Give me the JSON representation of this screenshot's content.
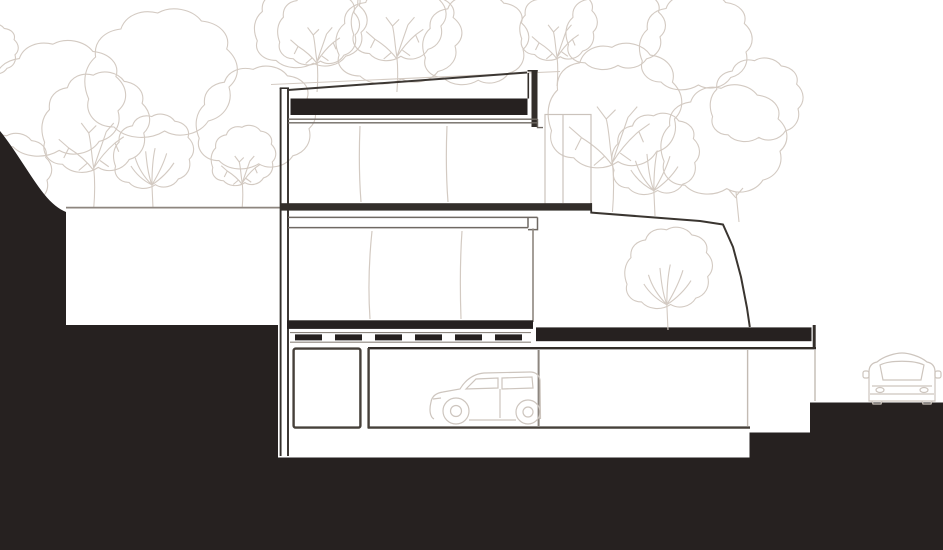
{
  "title": "Hillside house cross-section drawing",
  "colors": {
    "background": "#ffffff",
    "terrain": "#262120",
    "section": "#332e2a",
    "line_medium": "#6f6963",
    "line_light": "#8d867f",
    "room_outline": "#46403a",
    "vegetation": "#d3cac2",
    "vehicle_outline": "#cdc5be",
    "faint_volume": "#cbc3bc"
  },
  "scene": {
    "type": "architectural section through a house built into a slope",
    "site": {
      "left": "hillside cut drawn as solid dark fill stepping down toward the house",
      "right": "ground stepping down in two terraces to street level"
    },
    "building": {
      "levels": [
        {
          "name": "roof",
          "feature": "flat roof with dark gravel band, sloped edge line and parapets"
        },
        {
          "name": "upper-floor",
          "feature": "open glazed floor with faint mullion lines"
        },
        {
          "name": "ground-floor",
          "feature": "glazed floor, slab running out to meet the terrain"
        },
        {
          "name": "basement",
          "rooms": [
            "storage room",
            "garage",
            "carport"
          ]
        }
      ],
      "extras": [
        "deck slats over garage slab",
        "dark terrace roof band with tree planted on it",
        "set-back stair volume drawn faint"
      ]
    },
    "vehicles": [
      {
        "name": "car in garage",
        "view": "side, facing left"
      },
      {
        "name": "car at street",
        "view": "front"
      }
    ],
    "vegetation": "outline deciduous trees behind and beside the house and on the terrace roof"
  }
}
